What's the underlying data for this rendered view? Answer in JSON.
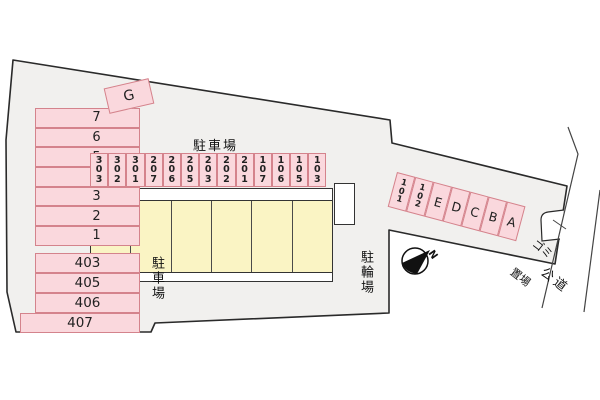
{
  "labels": {
    "parking_center": "駐車場",
    "parking_left": "駐車場",
    "bicycle_parking": "駐輪場",
    "garbage_line1": "ゴミ",
    "garbage_line2": "置場",
    "public_road": "公道",
    "north_mark": "N",
    "g_building": "G"
  },
  "spaces": {
    "left_upper": [
      "7",
      "6",
      "5",
      "4",
      "3",
      "2",
      "1"
    ],
    "left_lower": [
      "403",
      "405",
      "406",
      "407"
    ],
    "center_row": [
      "303",
      "302",
      "301",
      "207",
      "206",
      "205",
      "203",
      "202",
      "201",
      "107",
      "106",
      "105",
      "103"
    ],
    "right_row": [
      "101",
      "102",
      "E",
      "D",
      "C",
      "B",
      "A"
    ]
  },
  "building": {
    "units": 6
  },
  "colors": {
    "site_fill": "#f1f0ee",
    "space_fill": "#fad8dd",
    "space_border": "#d4838c",
    "building_fill": "#faf4c4",
    "outline": "#2a2a2a",
    "thin_line": "#444444"
  }
}
